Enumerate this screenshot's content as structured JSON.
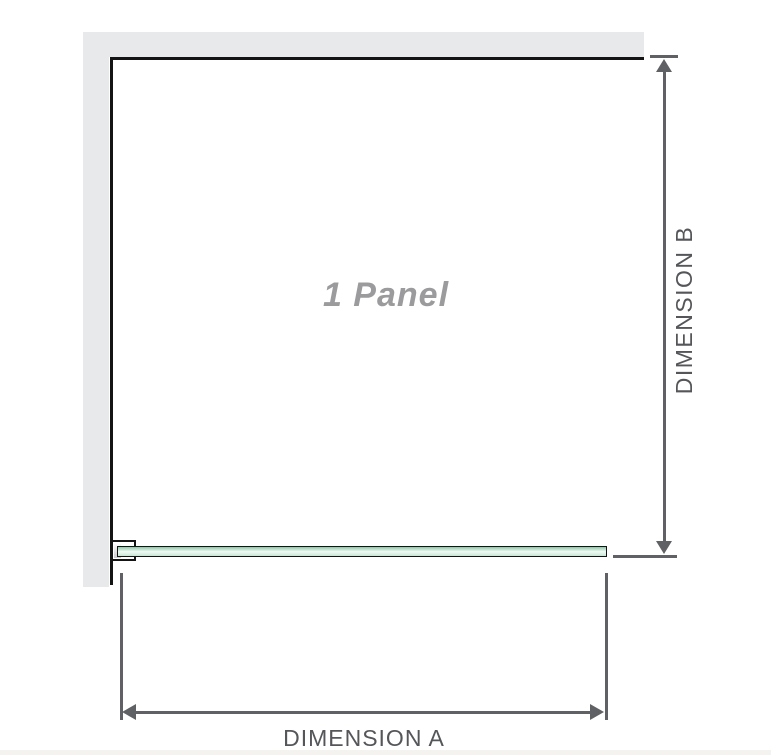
{
  "diagram": {
    "panel_label": "1 Panel",
    "dimensions": {
      "a_label": "DIMENSION A",
      "b_label": "DIMENSION B"
    }
  },
  "icons": {
    "arrow_up": "arrow-up-icon",
    "arrow_down": "arrow-down-icon",
    "arrow_left": "arrow-left-icon",
    "arrow_right": "arrow-right-icon"
  },
  "colors": {
    "wall": "#e8e9eb",
    "edge": "#141414",
    "dim_line": "#606164",
    "dim_text": "#55565a",
    "panel_text": "#9b9b9d",
    "glass_top": "#8ac8a6",
    "glass_mid": "#f1faf4",
    "glass_bottom": "#c8e7d4",
    "bottom_strip": "#f5f3f0"
  }
}
